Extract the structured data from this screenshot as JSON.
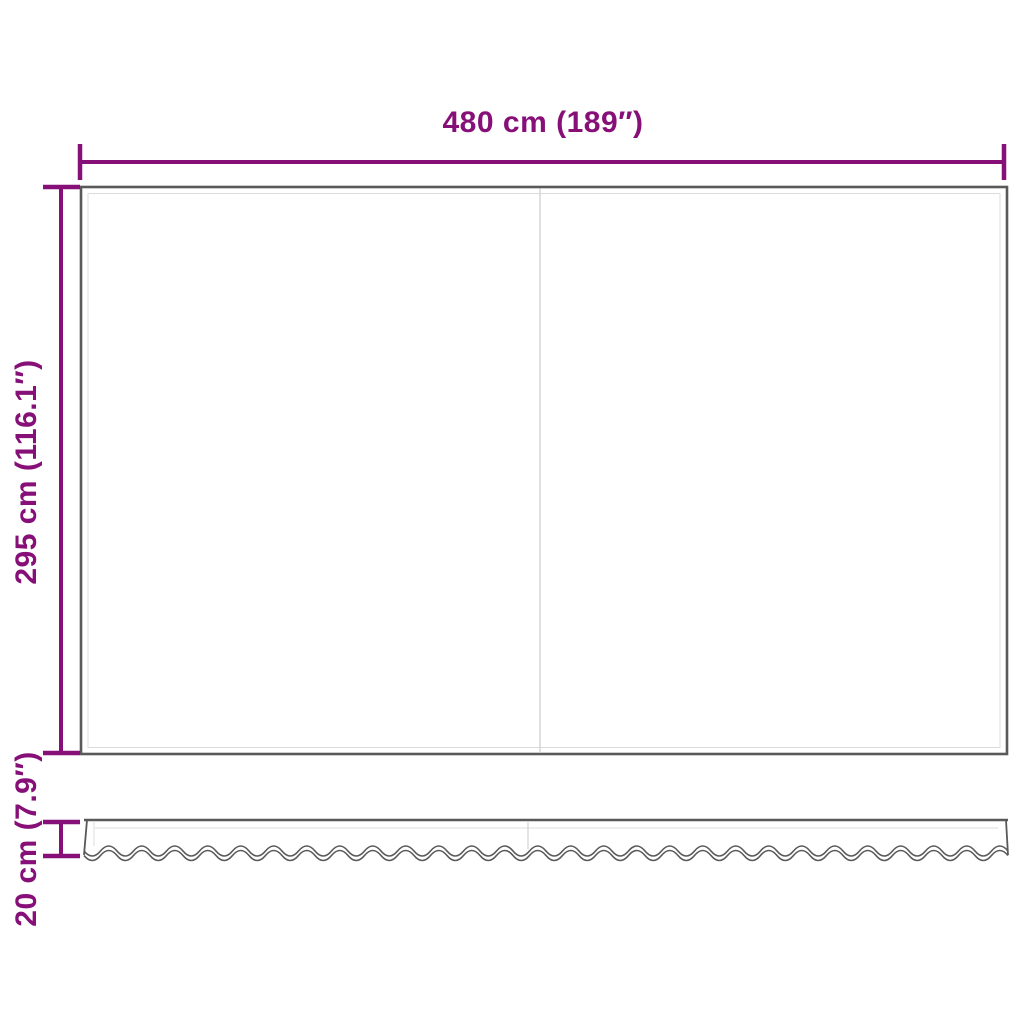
{
  "colors": {
    "background": "#ffffff",
    "accent_purple": "#870F78",
    "fabric_outline": "#595959",
    "hem_line": "#dcdcdc",
    "seam_line": "#d2d2d2"
  },
  "dimensions": {
    "width_label": "480 cm (189″)",
    "height_label": "295 cm (116.1″)",
    "valance_label": "20 cm (7.9″)",
    "width_cm": 480,
    "width_inches": 189,
    "height_cm": 295,
    "height_inches": 116.1,
    "valance_cm": 20,
    "valance_inches": 7.9
  }
}
